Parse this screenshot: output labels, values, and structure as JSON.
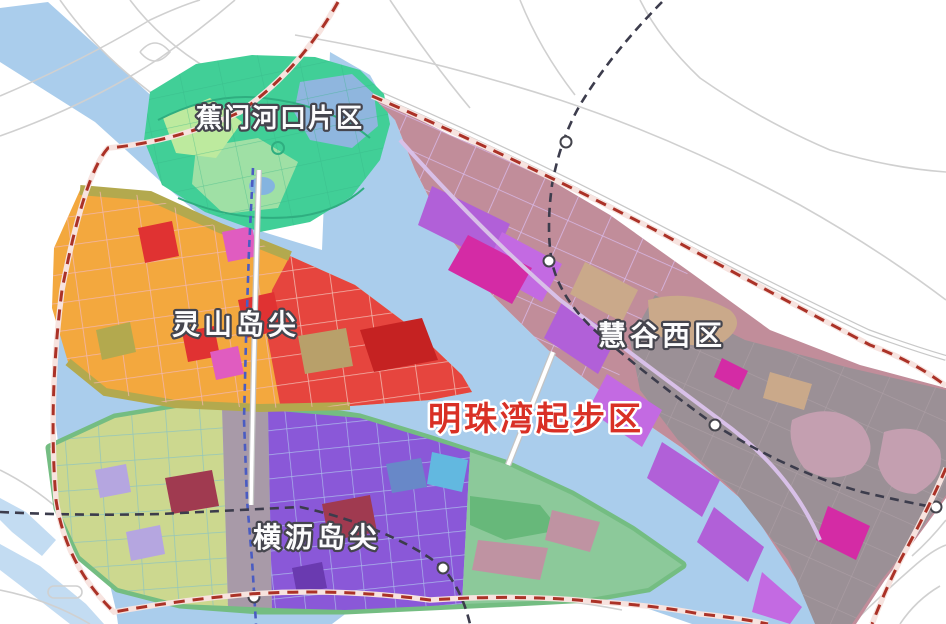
{
  "map": {
    "labels": {
      "jiaomen": "蕉门河口片区",
      "lingshan": "灵山岛尖",
      "huigu": "慧谷西区",
      "hengli": "横沥岛尖",
      "mingzhuwan": "明珠湾起步区"
    },
    "regions": [
      {
        "id": "jiaomen",
        "label": "蕉门河口片区",
        "fill": "#41cf97"
      },
      {
        "id": "lingshan",
        "label": "灵山岛尖",
        "fill": "#f3a83e",
        "accent": "#e6453e"
      },
      {
        "id": "huigu",
        "label": "慧谷西区",
        "fill": "#c18d9a",
        "accent": "#b160d8"
      },
      {
        "id": "hengli",
        "label": "横沥岛尖",
        "fill": "#ccd88f",
        "accent": "#8a58d8"
      }
    ],
    "colors": {
      "land": "#ffffff",
      "water": "#aacdec",
      "water_light": "#c3dcf2",
      "boundary": "#ab3227",
      "boundary_casing": "#f7e3df",
      "metro_dark": "#3c3c4c",
      "metro_blue": "#4a5cc2",
      "shore_green": "#74bd82",
      "jiaomen_fill": "#41cf97",
      "lingshan_fill": "#f3a83e",
      "lingshan_red": "#e6453e",
      "huigu_rose": "#c18d9a",
      "huigu_purple": "#b160d8",
      "huigu_gray": "#9b9096",
      "hengli_green": "#ccd88f",
      "hengli_mauve": "#a89aa8",
      "hengli_purple": "#8a58d8",
      "hengli_tip": "#8cc99a",
      "title_red": "#d93025",
      "station_stroke": "#44444c"
    }
  }
}
